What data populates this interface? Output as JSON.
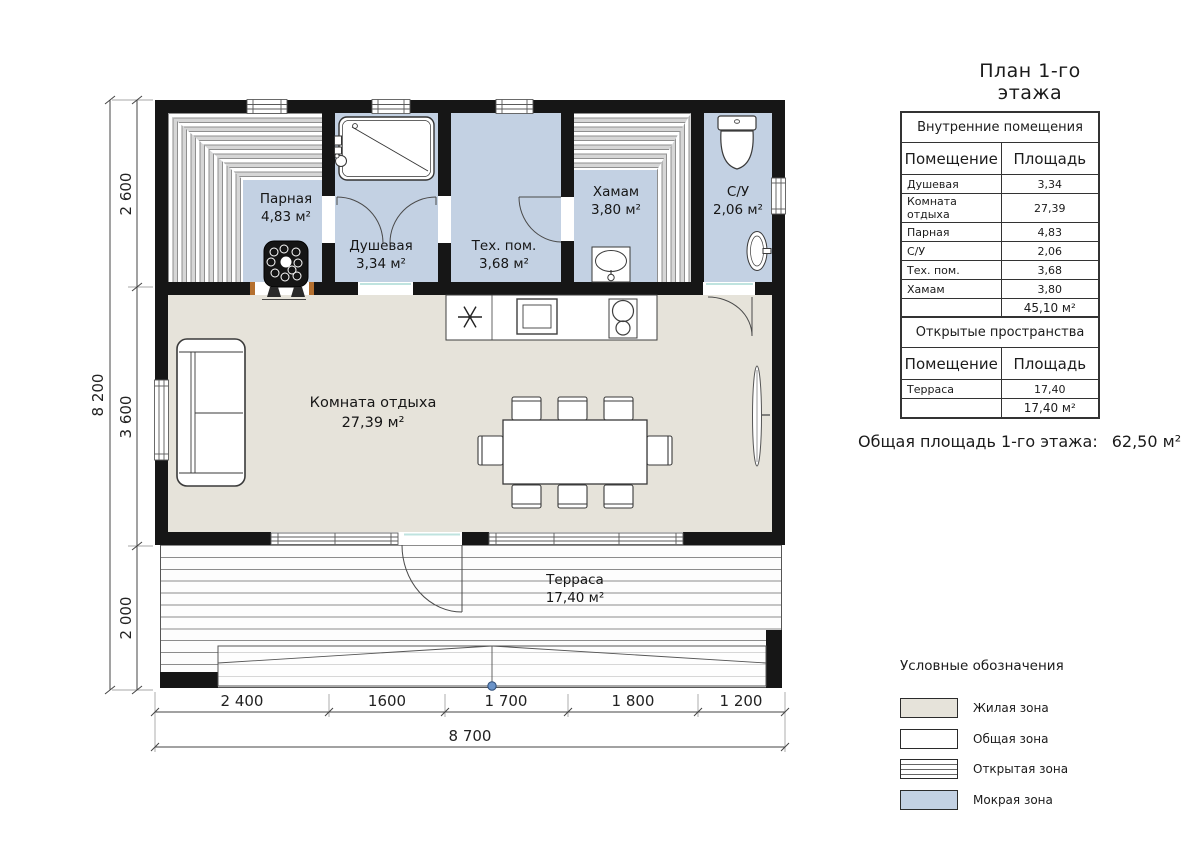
{
  "title": "План 1-го этажа",
  "colors": {
    "wall": "#161616",
    "wet_zone": "#c3d1e3",
    "living_zone": "#e6e3da",
    "common_zone": "#ffffff",
    "open_zone": "#ffffff",
    "accent_orange": "#b5702f",
    "marker_blue": "#6b93c8"
  },
  "rooms": {
    "parnaya": {
      "name": "Парная",
      "area": "4,83 м²"
    },
    "dushevaya": {
      "name": "Душевая",
      "area": "3,34 м²"
    },
    "tekh": {
      "name": "Тех. пом.",
      "area": "3,68 м²"
    },
    "hamam": {
      "name": "Хамам",
      "area": "3,80 м²"
    },
    "su": {
      "name": "С/У",
      "area": "2,06 м²"
    },
    "lounge": {
      "name": "Комната отдыха",
      "area": "27,39 м²"
    },
    "terrace": {
      "name": "Терраса",
      "area": "17,40 м²"
    }
  },
  "dimensions": {
    "left": {
      "total": "8 200",
      "segments": [
        "2 600",
        "3 600",
        "2 000"
      ]
    },
    "bottom": {
      "total": "8 700",
      "segments": [
        "2 400",
        "1600",
        "1 700",
        "1 800",
        "1 200"
      ]
    }
  },
  "tables": {
    "interior": {
      "title": "Внутренние помещения",
      "col_room": "Помещение",
      "col_area": "Площадь",
      "rows": [
        {
          "room": "Душевая",
          "area": "3,34"
        },
        {
          "room": "Комната отдыха",
          "area": "27,39"
        },
        {
          "room": "Парная",
          "area": "4,83"
        },
        {
          "room": "С/У",
          "area": "2,06"
        },
        {
          "room": "Тех. пом.",
          "area": "3,68"
        },
        {
          "room": "Хамам",
          "area": "3,80"
        }
      ],
      "total": "45,10 м²"
    },
    "open": {
      "title": "Открытые пространства",
      "col_room": "Помещение",
      "col_area": "Площадь",
      "rows": [
        {
          "room": "Терраса",
          "area": "17,40"
        }
      ],
      "total": "17,40 м²"
    }
  },
  "summary": {
    "label": "Общая площадь 1-го этажа:",
    "value": "62,50 м²"
  },
  "legend": {
    "title": "Условные обозначения",
    "items": [
      {
        "label": "Жилая зона"
      },
      {
        "label": "Общая зона"
      },
      {
        "label": "Открытая зона"
      },
      {
        "label": "Мокрая зона"
      }
    ]
  }
}
